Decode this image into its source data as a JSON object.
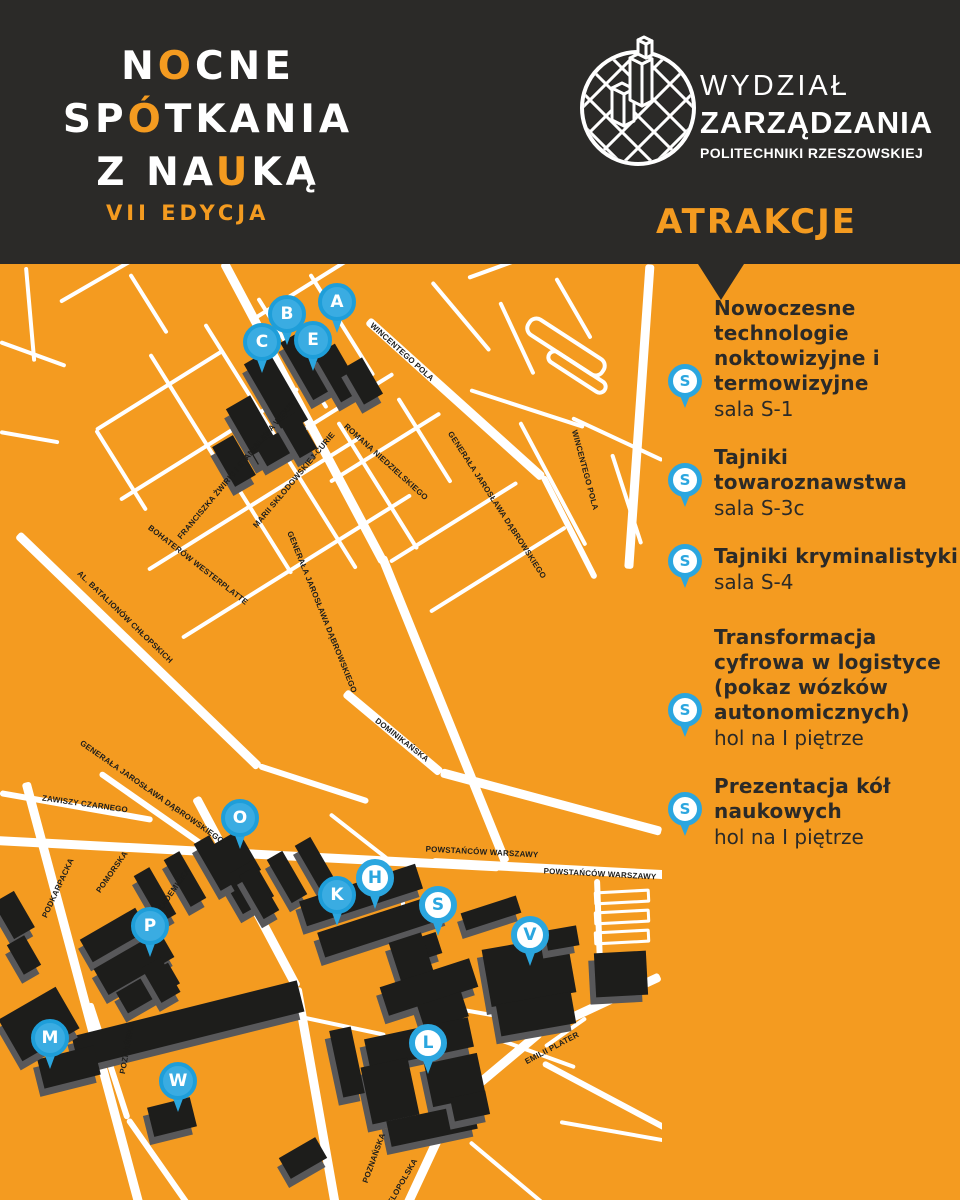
{
  "header": {
    "logo": {
      "line1_pre": "N",
      "line1_accent": "O",
      "line1_post": "CNE",
      "line2_pre": "SP",
      "line2_accent": "Ó",
      "line2_post": "TKANIA",
      "line3_pre": "Z NA",
      "line3_accent": "U",
      "line3_post": "KĄ",
      "edition": "VII EDYCJA"
    },
    "faculty": {
      "line1": "WYDZIAŁ",
      "line2": "ZARZĄDZANIA",
      "line3": "POLITECHNIKI RZESZOWSKIEJ"
    }
  },
  "sidebar": {
    "title": "ATRAKCJE",
    "items": [
      {
        "title": "Nowoczesne technologie noktowizyjne i termowizyjne",
        "location": "sala S-1",
        "pin": "S"
      },
      {
        "title": "Tajniki towaroznawstwa",
        "location": "sala S-3c",
        "pin": "S"
      },
      {
        "title": "Tajniki kryminalistyki",
        "location": "sala S-4",
        "pin": "S"
      },
      {
        "title": "Transformacja cyfrowa w logistyce (pokaz wózków autonomicznych)",
        "location": "hol na I piętrze",
        "pin": "S"
      },
      {
        "title": "Prezentacja kół naukowych",
        "location": "hol na I piętrze",
        "pin": "S"
      }
    ]
  },
  "map": {
    "markers": [
      {
        "letter": "A",
        "x": 337,
        "y": 302,
        "style": "solid"
      },
      {
        "letter": "B",
        "x": 287,
        "y": 314,
        "style": "solid"
      },
      {
        "letter": "C",
        "x": 262,
        "y": 342,
        "style": "solid"
      },
      {
        "letter": "E",
        "x": 313,
        "y": 340,
        "style": "solid"
      },
      {
        "letter": "O",
        "x": 240,
        "y": 818,
        "style": "solid"
      },
      {
        "letter": "P",
        "x": 150,
        "y": 926,
        "style": "solid"
      },
      {
        "letter": "K",
        "x": 337,
        "y": 895,
        "style": "solid"
      },
      {
        "letter": "H",
        "x": 375,
        "y": 878,
        "style": "outline"
      },
      {
        "letter": "S",
        "x": 438,
        "y": 905,
        "style": "outline"
      },
      {
        "letter": "V",
        "x": 530,
        "y": 935,
        "style": "outline"
      },
      {
        "letter": "M",
        "x": 50,
        "y": 1038,
        "style": "solid"
      },
      {
        "letter": "W",
        "x": 178,
        "y": 1081,
        "style": "solid"
      },
      {
        "letter": "L",
        "x": 428,
        "y": 1043,
        "style": "outline"
      }
    ],
    "street_labels": [
      {
        "text": "WINCENTEGO POLA",
        "x": 402,
        "y": 352,
        "rot": 42
      },
      {
        "text": "WINCENTEGO POLA",
        "x": 585,
        "y": 470,
        "rot": 75
      },
      {
        "text": "ROMANA NIEDZIELSKIEGO",
        "x": 386,
        "y": 462,
        "rot": 42
      },
      {
        "text": "FRANCISZKA ŻWIRKI I STANISŁAWA WIGURY",
        "x": 238,
        "y": 468,
        "rot": -50
      },
      {
        "text": "MARII SKŁODOWSKIEJ-CURIE",
        "x": 294,
        "y": 480,
        "rot": -50
      },
      {
        "text": "GENERAŁA JAROSŁAWA DĄBROWSKIEGO",
        "x": 322,
        "y": 612,
        "rot": 68
      },
      {
        "text": "GENERAŁA JAROSŁAWA DĄBROWSKIEGO",
        "x": 497,
        "y": 505,
        "rot": 57
      },
      {
        "text": "GENERAŁA JAROSŁAWA DĄBROWSKIEGO",
        "x": 152,
        "y": 792,
        "rot": 35
      },
      {
        "text": "AL. BATALIONÓW CHŁOPSKICH",
        "x": 125,
        "y": 617,
        "rot": 44
      },
      {
        "text": "BOHATERÓW WESTERPLATTE",
        "x": 198,
        "y": 565,
        "rot": 38
      },
      {
        "text": "ZAWISZY CZARNEGO",
        "x": 85,
        "y": 804,
        "rot": 8
      },
      {
        "text": "DOMINIKAŃSKA",
        "x": 402,
        "y": 740,
        "rot": 38
      },
      {
        "text": "POWSTAŃCÓW WARSZAWY",
        "x": 482,
        "y": 852,
        "rot": 3
      },
      {
        "text": "POWSTAŃCÓW WARSZAWY",
        "x": 600,
        "y": 874,
        "rot": 3
      },
      {
        "text": "PODKARPACKA",
        "x": 58,
        "y": 888,
        "rot": -65
      },
      {
        "text": "POMORSKA",
        "x": 112,
        "y": 872,
        "rot": -55
      },
      {
        "text": "AKADEMICKA",
        "x": 172,
        "y": 892,
        "rot": -55
      },
      {
        "text": "POZNAŃSKA",
        "x": 127,
        "y": 1048,
        "rot": -80
      },
      {
        "text": "EMILII PLATER",
        "x": 552,
        "y": 1048,
        "rot": -28
      },
      {
        "text": "POZNAŃSKA",
        "x": 374,
        "y": 1158,
        "rot": -70
      },
      {
        "text": "WIELOPOLSKA",
        "x": 400,
        "y": 1186,
        "rot": -60
      }
    ]
  },
  "colors": {
    "orange": "#F49B20",
    "dark": "#2B2A28",
    "blue": "#2BA6DF",
    "building": "#1D1D1B"
  }
}
